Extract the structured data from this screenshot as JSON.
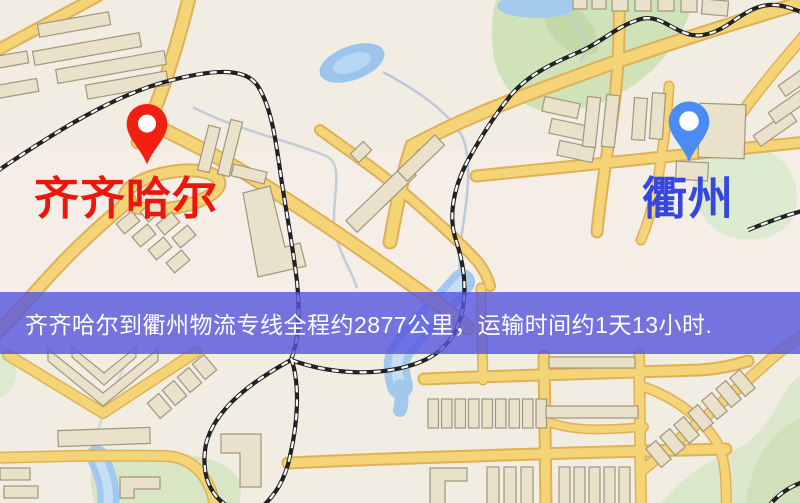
{
  "origin": {
    "label": "齐齐哈尔"
  },
  "destination": {
    "label": "衢州"
  },
  "banner": {
    "text": "齐齐哈尔到衢州物流专线全程约2877公里，运输时间约1天13小时."
  },
  "icons": {
    "origin_pin": "red-map-pin",
    "destination_pin": "blue-map-pin"
  },
  "colors": {
    "origin_label": "#ee150b",
    "destination_label": "#3447e0",
    "origin_pin": "#f32012",
    "destination_pin": "#4a8cf3",
    "banner_bg": "rgba(85,85,222,0.80)",
    "banner_text": "#ffffff",
    "map_background": "#f2ede2",
    "road": "#f5d377",
    "road_casing": "#dfb157",
    "water": "#a3c8ee",
    "park": "#cfe2b8",
    "building": "#e9e1c9",
    "railway": "#222222"
  }
}
